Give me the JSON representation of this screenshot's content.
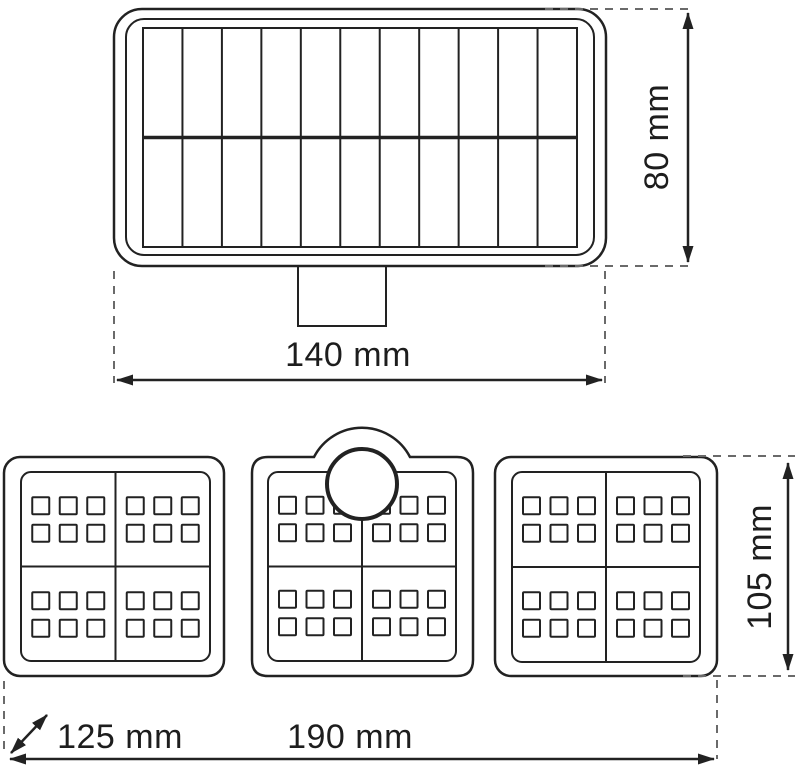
{
  "diagram": {
    "dimensions": {
      "panel_width": "140 mm",
      "panel_height": "80 mm",
      "light_depth": "125 mm",
      "light_width": "190 mm",
      "light_height": "105 mm"
    },
    "solar_panel": {
      "grid_columns": 11,
      "grid_rows": 2
    },
    "led_section": {
      "panel_count": 3,
      "quadrants_per_panel": 4,
      "led_columns_per_quadrant": 3,
      "led_rows_per_quadrant": 2,
      "sensor_count": 1
    },
    "colors": {
      "line": "#222222",
      "dash": "#6a6a6a",
      "text": "#1d1d1d",
      "background": "#ffffff"
    }
  }
}
